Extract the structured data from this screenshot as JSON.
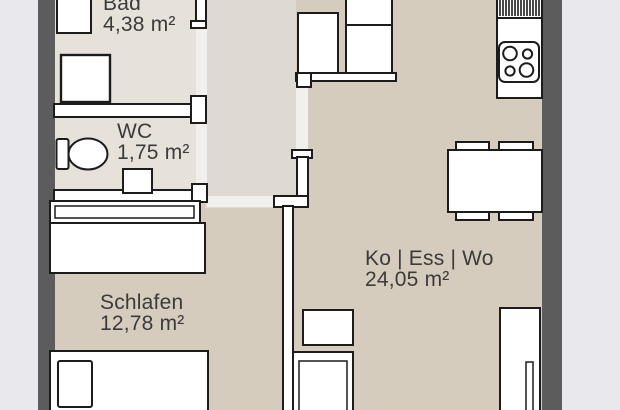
{
  "plan": {
    "type": "apartment-floor-plan",
    "rooms": [
      {
        "name": "Bad",
        "area": "4,38 m²"
      },
      {
        "name": "WC",
        "area": "1,75 m²"
      },
      {
        "name": "Schlafen",
        "area": "12,78 m²"
      },
      {
        "name": "Ko | Ess | Wo",
        "area": "24,05 m²"
      }
    ],
    "fixtures": {
      "bad": [
        "washbasin",
        "washing-machine"
      ],
      "wc": [
        "toilet",
        "hand-basin"
      ],
      "schlafen": [
        "wall-shelf",
        "wardrobe",
        "bed-with-pillow"
      ],
      "ko-ess-wo": [
        "built-in-wardrobe",
        "kitchen-counter",
        "radiator",
        "cooktop-4-burners",
        "dining-table",
        "four-chairs",
        "small-cabinet",
        "armchair",
        "sideboard"
      ]
    },
    "colors": {
      "background": "#e9e9ed",
      "outer_wall": "#5c5c5c",
      "floor_living": "#d5ccbe",
      "floor_wet_rooms": "#e6e2da",
      "floor_hall": "#dedad3",
      "door_threshold": "#f2f0ec",
      "inner_wall_fill": "#ffffff",
      "outline": "#1c1c1c",
      "label_text": "#3b3b3b"
    }
  }
}
